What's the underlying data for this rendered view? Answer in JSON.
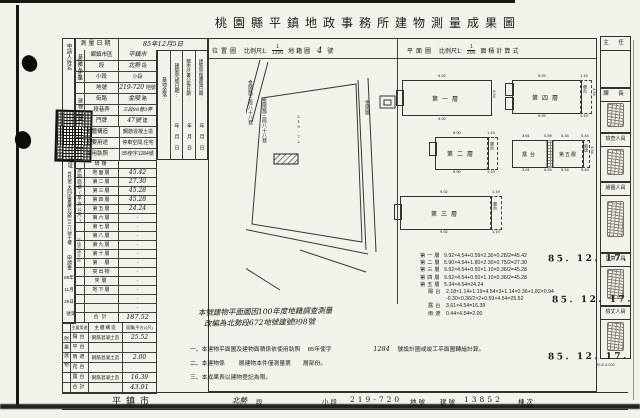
{
  "title": "桃園縣平鎮地政事務所建物測量成果圖",
  "applicant": {
    "name_label": "申請人姓名",
    "rep_label": "代表人蓋章",
    "address_label": "住址",
    "address_value": "台北市大同區重慶北路三三八號十樓",
    "doc_label": "申請書",
    "receipt_date": [
      "85年",
      "11月",
      "29日"
    ],
    "receipt_no": "第　號",
    "receipt_stamp": "平鎮市建字第"
  },
  "survey": {
    "label": "測量日期",
    "value": "85年12月5日"
  },
  "groups": {
    "site": "基地坐落",
    "door": "建物門牌",
    "area": "建物面積(平方公尺)",
    "attached": "附屬建物"
  },
  "info_rows": [
    {
      "label": "鄉鎮市區",
      "value": "平鎮市",
      "suffix": ""
    },
    {
      "label": "段",
      "value": "北勢",
      "suffix": "段"
    },
    {
      "label": "小段",
      "value": "",
      "suffix": "小段"
    },
    {
      "label": "地號",
      "value": "219-720",
      "suffix": "地號"
    },
    {
      "label": "街路",
      "value": "金陵",
      "suffix": "路"
    },
    {
      "label": "段巷弄",
      "value": "三段88巷3弄",
      "suffix": ""
    },
    {
      "label": "門牌",
      "value": "47號",
      "suffix": "建"
    },
    {
      "label": "主體構造",
      "value": "鋼筋混凝土造",
      "suffix": ""
    },
    {
      "label": "主要用途",
      "value": "停車空間,住宅",
      "suffix": ""
    },
    {
      "label": "使用執照",
      "value": "85使字1284號",
      "suffix": ""
    }
  ],
  "floor_rows": [
    {
      "label": "騎樓",
      "value": ""
    },
    {
      "label": "地面層",
      "value": "45.42"
    },
    {
      "label": "第二層",
      "value": "27.30"
    },
    {
      "label": "第三層",
      "value": "45.28"
    },
    {
      "label": "第四層",
      "value": "45.28"
    },
    {
      "label": "第五層",
      "value": "24.24"
    },
    {
      "label": "第六層",
      "value": "·"
    },
    {
      "label": "第七層",
      "value": "·"
    },
    {
      "label": "第八層",
      "value": "·"
    },
    {
      "label": "第九層",
      "value": "·"
    },
    {
      "label": "第十層",
      "value": "·"
    },
    {
      "label": "第　層",
      "value": "·"
    },
    {
      "label": "突出物",
      "value": "·"
    },
    {
      "label": "夾層",
      "value": "·"
    },
    {
      "label": "地下層",
      "value": "·"
    },
    {
      "label": "",
      "value": "·"
    },
    {
      "label": "",
      "value": "·"
    },
    {
      "label": "合計",
      "value": "187.52"
    }
  ],
  "attached_table": {
    "use_header": "主要用途",
    "structure_header": "主體構造",
    "area_header": "面積(平方公尺)",
    "rows": [
      {
        "label": "陽台",
        "structure": "鋼筋混凝土造",
        "value": "25.52"
      },
      {
        "label": "平台",
        "structure": "",
        "value": ""
      },
      {
        "label": "雨遮",
        "structure": "鋼筋混凝土造",
        "value": "2.00"
      },
      {
        "label": "花台",
        "structure": "",
        "value": ""
      },
      {
        "label": "露台",
        "structure": "鋼筋混凝土造",
        "value": "16.39"
      },
      {
        "label": "合計",
        "structure": "",
        "value": "43.91"
      }
    ]
  },
  "middle_strips": {
    "site": "基地坐落:",
    "complete": "建築完成日期:",
    "plan": "都市計畫公佈日期:",
    "admin": "建築管理實施日期:",
    "ymd": "年月日"
  },
  "map": {
    "title": "位置圖",
    "scale_prefix": "比例尺1:",
    "scale_num": "1",
    "scale_den": "1200",
    "sheet_label": "地籍圖",
    "sheet_no": "4",
    "sheet_suffix": "號",
    "road_left": "金陵路三段八十八巷",
    "road_center": "金陵路三段八十八巷",
    "road_right": "金陵路",
    "parcel_label": "219-72"
  },
  "plans": {
    "title": "平面圖",
    "scale_prefix": "比例尺1:",
    "scale_num": "1",
    "scale_den": "200",
    "calc_label": "面積計算式",
    "floor1": "第一層",
    "floor2": "第二層",
    "floor3": "第三層",
    "floor4": "第四層",
    "floor5": "第五層",
    "balcony": "陽台",
    "terrace": "露台",
    "canopy": "雨遮",
    "dim_992": "9.92",
    "dim_590": "5.90",
    "dim_454": "4.54",
    "dim_119": "1.19",
    "dim_361": "3.61",
    "dim_059": "0.59",
    "dim_534": "5.34",
    "dim_044": "0.44"
  },
  "formulas": [
    {
      "name": "第一層",
      "expr": "9.92×4.54+0.59×2.30×0.28/2=45.42"
    },
    {
      "name": "第二層",
      "expr": "5.90×4.54+1.80×2.30×0.75/2=27.30"
    },
    {
      "name": "第三層",
      "expr": "9.92×4.54+0.50×1.10×0.36/2=45.28"
    },
    {
      "name": "第四層",
      "expr": "9.92×4.54+0.50×1.10×0.36/2=45.28"
    },
    {
      "name": "第五層",
      "expr": "5.34×4.54=24.24"
    },
    {
      "name": "陽台",
      "expr": "2.18×1.14+1.19×4.54×3+1.14×0.36+1.82×0.94"
    },
    {
      "name": "",
      "expr": "-0.30×0.36/2×2+0.59×4.54=25.52"
    },
    {
      "name": "露台",
      "expr": "3.61×4.54=16.39"
    },
    {
      "name": "雨遮",
      "expr": "0.44×4.54=2.00"
    }
  ],
  "notes": {
    "hand1": "本號建物平面圖因100年度地籍調查測量",
    "hand2": "改編為北勢段672地號建號998號",
    "n1a": "一、本建物平面圖及建物面積係依使用執照",
    "n1b": "85年使字",
    "n1c": "1284",
    "n1d": "號設計圖或竣工平面圖轉繪計算。",
    "n2a": "二、本建物係",
    "n2b": "層建物本件僅測量第",
    "n2c": "層部份。",
    "n3": "三、本成果表以建物登記為限。"
  },
  "bottom": {
    "city": "平鎮市",
    "section": "北勢",
    "section_suffix": "段",
    "subsection_label": "小段",
    "parcel_no": "219-720",
    "parcel_suffix": "地號",
    "building_label": "建號",
    "building_no": "13852",
    "unit_label": "棟次"
  },
  "officials": {
    "chief": "主 任",
    "manager": "課 長",
    "role_check": "檢查人員",
    "role_draw": "繪圖人員",
    "role_calc": "計算人員",
    "role_measure": "檢丈人員",
    "date1": "85. 12. 17.",
    "date2": "85. 12. 17.",
    "date3": "85. 12. 17.",
    "print_code": "85.6.3.000"
  }
}
